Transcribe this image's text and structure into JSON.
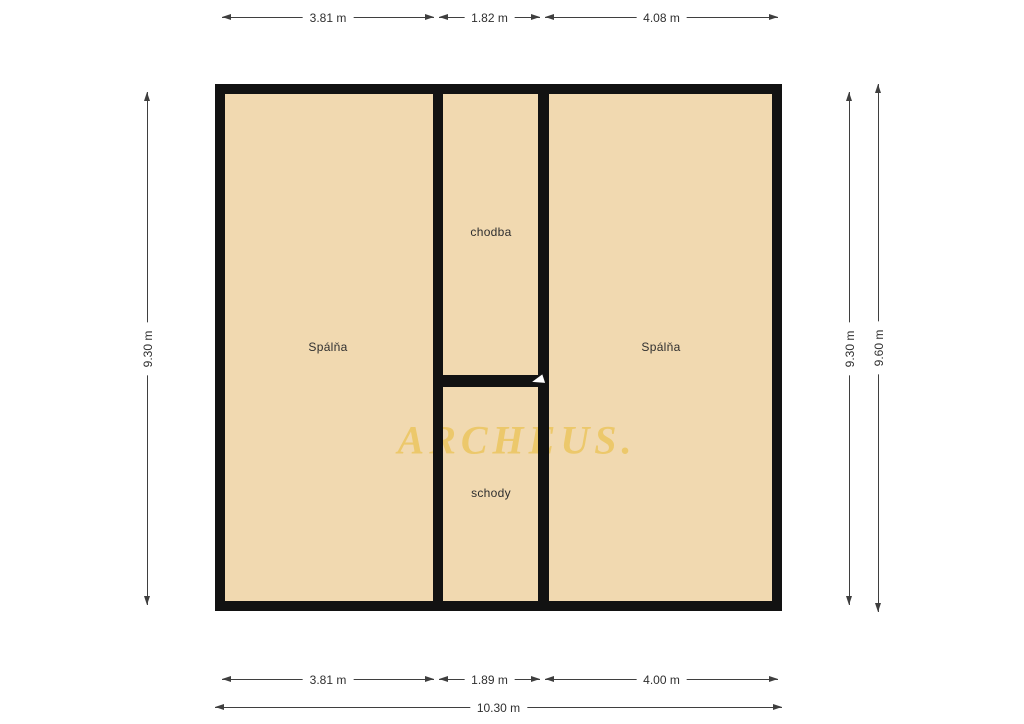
{
  "watermark": "ARCHEUS.",
  "rooms": {
    "left_bedroom": "Spálňa",
    "corridor": "chodba",
    "right_bedroom": "Spálňa",
    "stairs": "schody"
  },
  "dimensions": {
    "top": [
      "3.81 m",
      "1.82 m",
      "4.08 m"
    ],
    "bottom": [
      "3.81 m",
      "1.89 m",
      "4.00 m"
    ],
    "bottom_total": "10.30 m",
    "left": "9.30 m",
    "right_inner": "9.30 m",
    "right_outer": "9.60 m"
  },
  "colors": {
    "room_fill": "#f1d9b0",
    "wall": "#121212",
    "dimension_line": "#3f3f3f",
    "watermark": "#ecc65f",
    "background": "#ffffff"
  }
}
